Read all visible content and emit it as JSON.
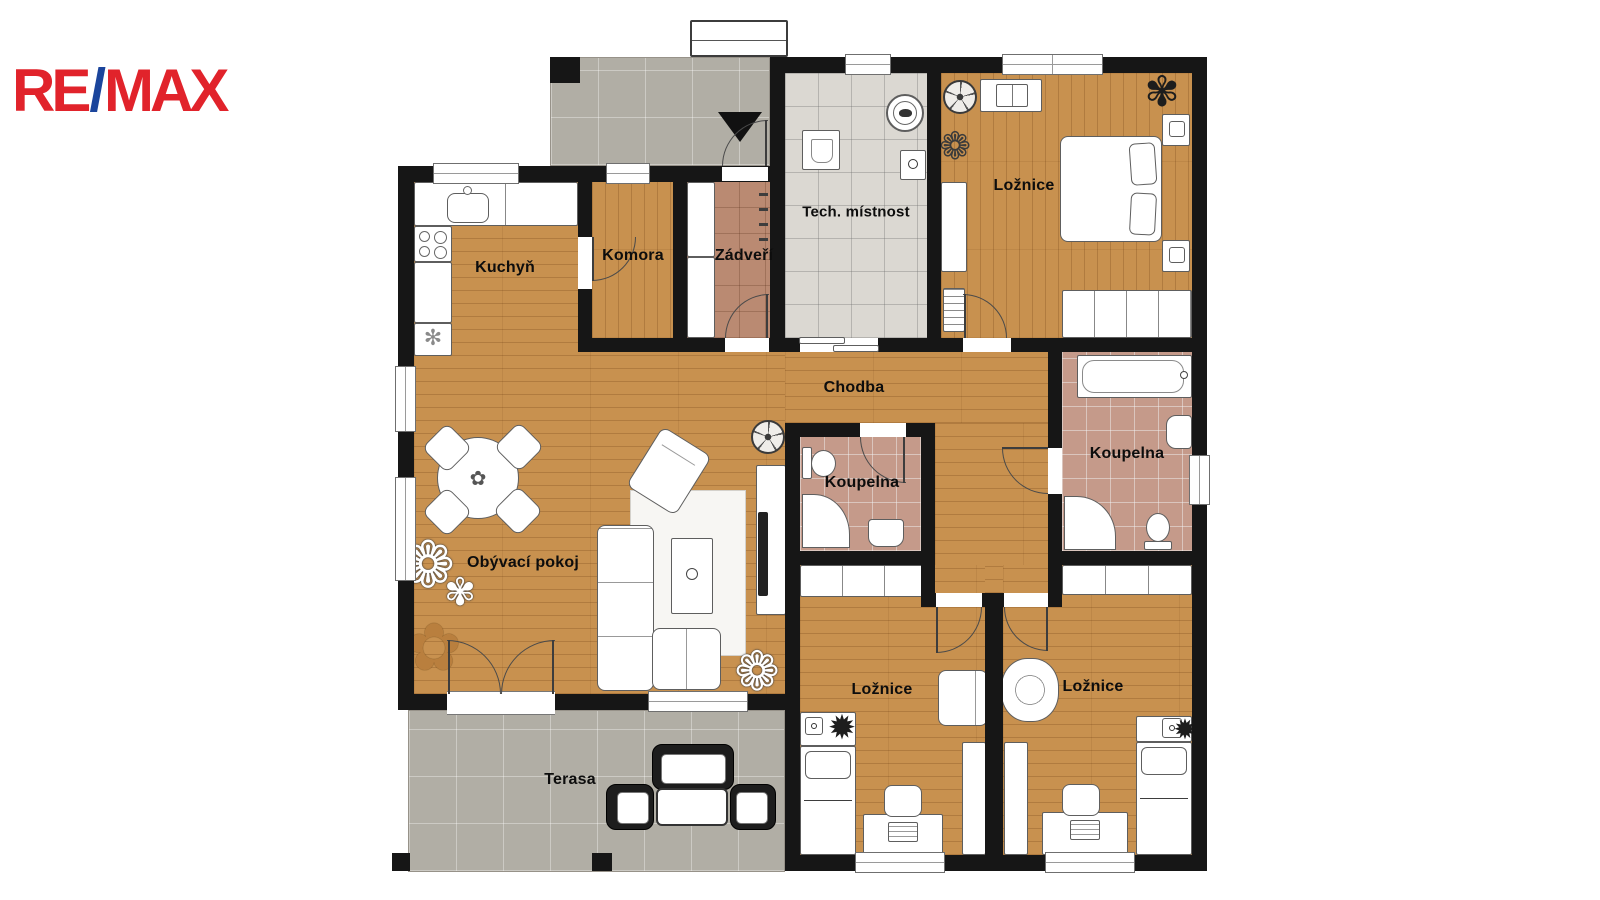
{
  "brand": {
    "re": "RE",
    "slash": "/",
    "max": "MAX",
    "color_red": "#E1232B",
    "color_blue": "#1B459C"
  },
  "rooms": {
    "kuchyn": {
      "label": "Kuchyň"
    },
    "komora": {
      "label": "Komora"
    },
    "zadveri": {
      "label": "Zádveří"
    },
    "tech_mistnost": {
      "label": "Tech. místnost"
    },
    "loznice_top": {
      "label": "Ložnice"
    },
    "chodba": {
      "label": "Chodba"
    },
    "koupelna_left": {
      "label": "Koupelna"
    },
    "koupelna_right": {
      "label": "Koupelna"
    },
    "obyvaci_pokoj": {
      "label": "Obývací pokoj"
    },
    "loznice_bottom_left": {
      "label": "Ložnice"
    },
    "loznice_bottom_right": {
      "label": "Ložnice"
    },
    "terasa": {
      "label": "Terasa"
    }
  },
  "icons": {
    "plant_flower": "❁",
    "plant_bush": "✾",
    "plant_spiky": "✹",
    "tree": "✿",
    "snowflake": "✻"
  },
  "colors": {
    "wall": "#161616",
    "wood_floor": "#C8914F",
    "tile_tech": "#DBD8D2",
    "tile_bath": "#C59A8A",
    "tile_entry": "#BA8A72",
    "tile_outdoor": "#B1AEA5"
  }
}
